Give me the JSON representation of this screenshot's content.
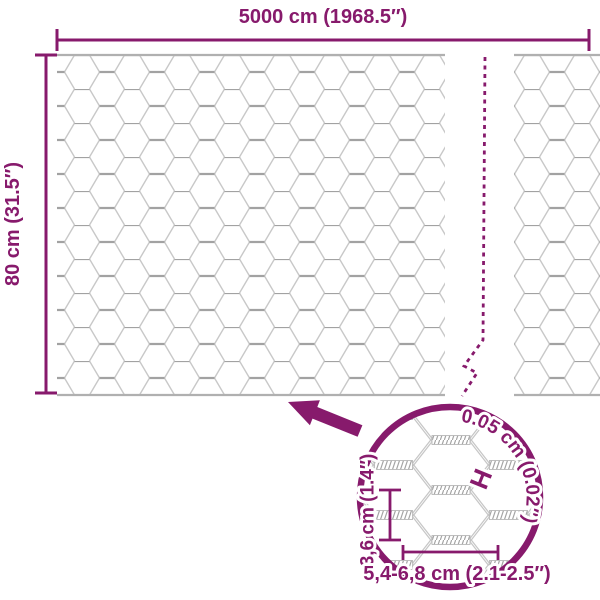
{
  "diagram": {
    "product": "hexagonal wire mesh roll",
    "dims": {
      "width_label": "5000 cm (1968.5″)",
      "height_label": "80 cm (31.5″)"
    },
    "detail": {
      "wire_thickness_label": "0.05 cm (0.02″)",
      "mesh_height_label": "3,6 cm (1.4″)",
      "mesh_width_label": "5,4-6,8 cm (2.1-2.5″)",
      "thickness_symbol": "H"
    },
    "colors": {
      "accent": "#871a6c",
      "mesh_diagonal": "#c8c8c8",
      "mesh_twist": "#a2a2a2",
      "selvage": "#b0b0b0"
    }
  }
}
